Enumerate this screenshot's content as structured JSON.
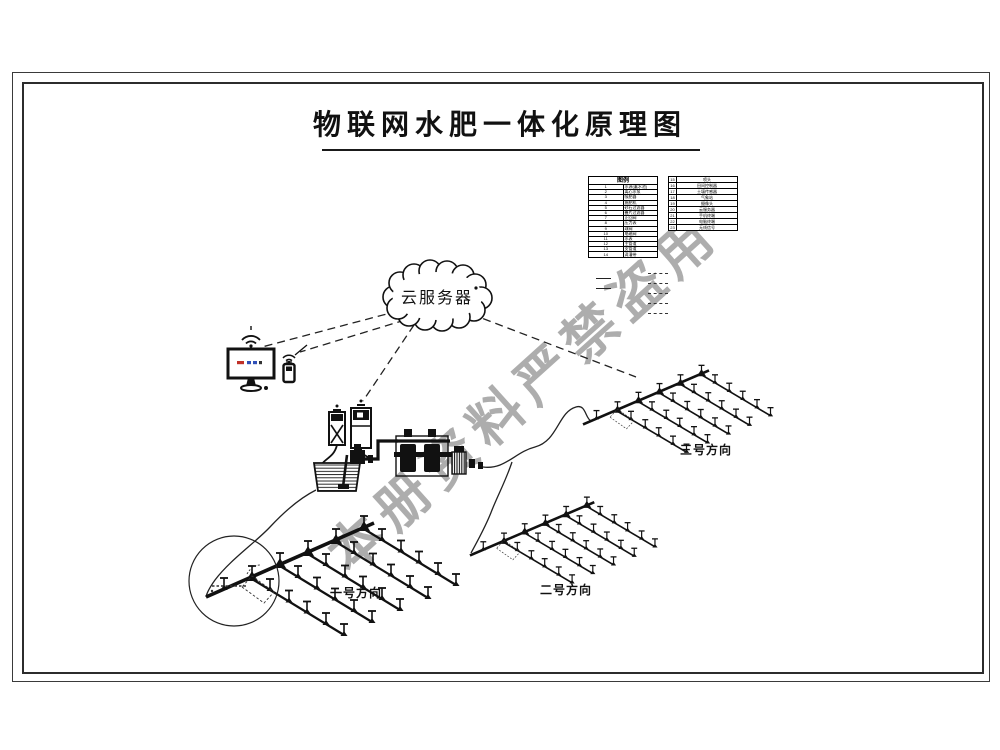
{
  "title": "物联网水肥一体化原理图",
  "watermark": "本册资料严禁盗用",
  "cloud": {
    "label": "云服务器"
  },
  "legend_left": {
    "header": "图例",
    "rows": [
      {
        "num": "1",
        "label": "水源(蓄水池)"
      },
      {
        "num": "2",
        "label": "离心水泵"
      },
      {
        "num": "3",
        "label": "吸肥器"
      },
      {
        "num": "4",
        "label": "施肥机"
      },
      {
        "num": "5",
        "label": "砂石过滤器"
      },
      {
        "num": "6",
        "label": "叠片过滤器"
      },
      {
        "num": "7",
        "label": "止回阀"
      },
      {
        "num": "8",
        "label": "压力表"
      },
      {
        "num": "9",
        "label": "球阀"
      },
      {
        "num": "10",
        "label": "电磁阀"
      },
      {
        "num": "11",
        "label": "水表"
      },
      {
        "num": "12",
        "label": "主管道"
      },
      {
        "num": "13",
        "label": "支管道"
      },
      {
        "num": "14",
        "label": "滴灌带"
      }
    ]
  },
  "legend_right": {
    "rows": [
      {
        "num": "15",
        "label": "喷头"
      },
      {
        "num": "16",
        "label": "田间控制器"
      },
      {
        "num": "17",
        "label": "土壤传感器"
      },
      {
        "num": "18",
        "label": "气象站"
      },
      {
        "num": "19",
        "label": "摄像头"
      },
      {
        "num": "20",
        "label": "云服务器"
      },
      {
        "num": "21",
        "label": "手机终端"
      },
      {
        "num": "22",
        "label": "电脑终端"
      },
      {
        "num": "23",
        "label": "无线信号"
      }
    ]
  },
  "directions": {
    "d1": "一号方向",
    "d2": "二号方向",
    "d3": "三号方向"
  },
  "colors": {
    "line": "#1a1a1a",
    "watermark": "#969696",
    "screen_red": "#c03028",
    "screen_blue": "#3050b8"
  }
}
